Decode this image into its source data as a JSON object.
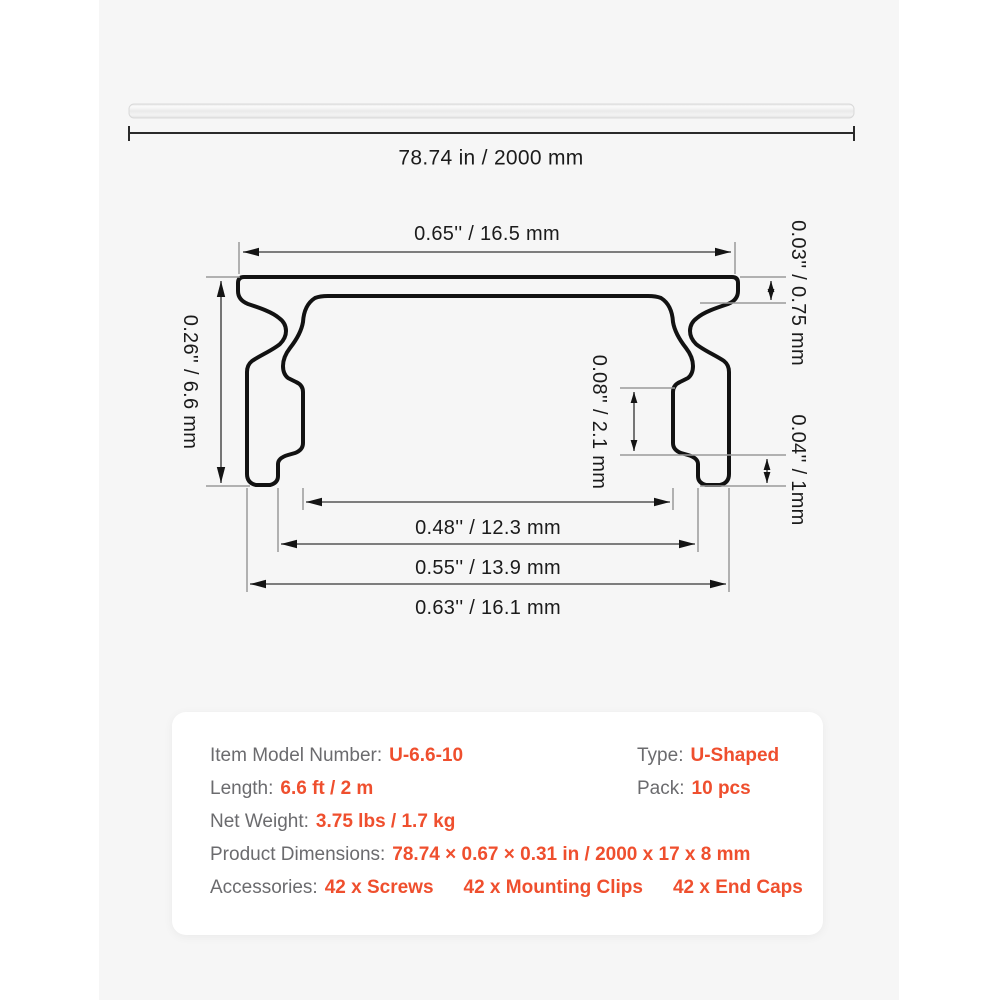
{
  "colors": {
    "canvas_bg": "#f6f6f6",
    "accent_orange": "#ef4f2e",
    "label_gray": "#6b6b6e",
    "line_black": "#121212"
  },
  "length_bar": {
    "label": "78.74 in / 2000 mm"
  },
  "diagram": {
    "dim_top_width": "0.65'' / 16.5 mm",
    "dim_left_height": "0.26'' / 6.6 mm",
    "dim_top_thickness": "0.03'' / 0.75 mm",
    "dim_notch_height": "0.08'' / 2.1 mm",
    "dim_foot_height": "0.04'' / 1mm",
    "dim_inner_width": "0.48'' / 12.3 mm",
    "dim_mid_width": "0.55'' / 13.9 mm",
    "dim_outer_width": "0.63'' / 16.1 mm"
  },
  "specs": {
    "left": [
      {
        "label": "Item Model Number:",
        "value": "U-6.6-10"
      },
      {
        "label": "Length:",
        "value": "6.6 ft / 2 m"
      },
      {
        "label": "Net Weight:",
        "value": "3.75 lbs / 1.7 kg"
      },
      {
        "label": "Product Dimensions:",
        "value": "78.74 × 0.67 × 0.31 in / 2000 x 17 x 8 mm"
      }
    ],
    "right": [
      {
        "label": "Type:",
        "value": "U-Shaped"
      },
      {
        "label": "Pack:",
        "value": "10 pcs"
      }
    ],
    "accessories": {
      "label": "Accessories:",
      "items": [
        "42 x Screws",
        "42 x Mounting Clips",
        "42 x End Caps"
      ]
    }
  }
}
